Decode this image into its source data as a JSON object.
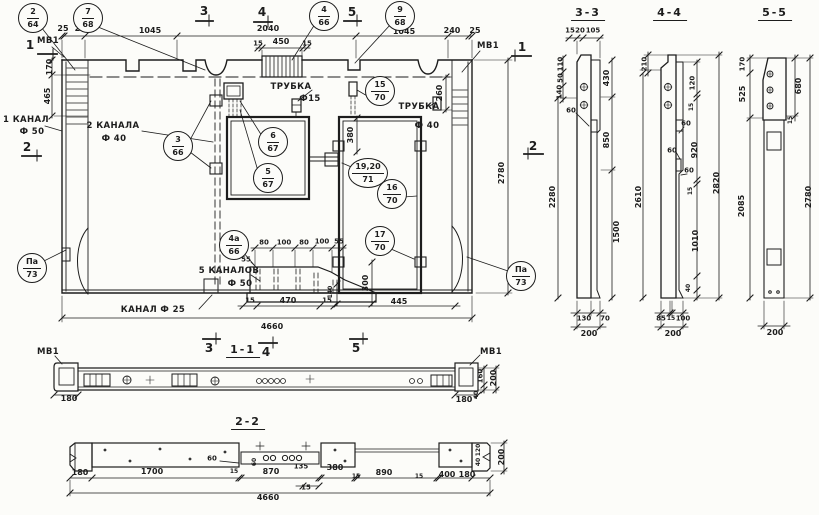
{
  "colors": {
    "ink": "#1d1d1d",
    "paper": "#fcfcf9"
  },
  "views": {
    "elevation": {
      "name": "panel-elevation",
      "texts": [
        {
          "t": "МВ1",
          "x": 48,
          "y": 41,
          "cls": "label",
          "n": "mv1-label"
        },
        {
          "t": "МВ1",
          "x": 488,
          "y": 46,
          "cls": "label",
          "n": "mv1-label"
        },
        {
          "t": "1 КАНАЛ",
          "x": 26,
          "y": 120,
          "cls": "label",
          "n": "canal1-label"
        },
        {
          "t": "Ф 50",
          "x": 32,
          "y": 132,
          "cls": "label",
          "n": "canal1-dia"
        },
        {
          "t": "2 КАНАЛА",
          "x": 113,
          "y": 126,
          "cls": "label",
          "n": "canal2-label"
        },
        {
          "t": "Ф 40",
          "x": 114,
          "y": 139,
          "cls": "label",
          "n": "canal2-dia"
        },
        {
          "t": "ТРУБКА",
          "x": 291,
          "y": 87,
          "cls": "label",
          "n": "tube-label"
        },
        {
          "t": "Ф15",
          "x": 310,
          "y": 99,
          "cls": "label",
          "n": "tube-dia"
        },
        {
          "t": "ТРУБКА",
          "x": 419,
          "y": 107,
          "cls": "label",
          "n": "tube-label"
        },
        {
          "t": "Ф 40",
          "x": 427,
          "y": 126,
          "cls": "label",
          "n": "tube-dia"
        },
        {
          "t": "5 КАНАЛОВ",
          "x": 229,
          "y": 271,
          "cls": "label",
          "n": "canals5-label"
        },
        {
          "t": "Ф 50",
          "x": 240,
          "y": 284,
          "cls": "label",
          "n": "canals5-dia"
        },
        {
          "t": "КАНАЛ Ф 25",
          "x": 153,
          "y": 310,
          "cls": "label",
          "n": "canal25-label"
        },
        {
          "t": "1",
          "x": 30,
          "y": 45,
          "cls": "mark"
        },
        {
          "t": "1",
          "x": 522,
          "y": 47,
          "cls": "mark"
        },
        {
          "t": "2",
          "x": 27,
          "y": 147,
          "cls": "mark"
        },
        {
          "t": "2",
          "x": 533,
          "y": 146,
          "cls": "mark"
        },
        {
          "t": "3",
          "x": 204,
          "y": 11,
          "cls": "mark"
        },
        {
          "t": "4",
          "x": 262,
          "y": 12,
          "cls": "mark"
        },
        {
          "t": "5",
          "x": 352,
          "y": 12,
          "cls": "mark"
        },
        {
          "t": "3",
          "x": 209,
          "y": 348,
          "cls": "mark"
        },
        {
          "t": "4",
          "x": 266,
          "y": 352,
          "cls": "mark"
        },
        {
          "t": "5",
          "x": 356,
          "y": 348,
          "cls": "mark"
        },
        {
          "t": "25",
          "x": 63,
          "y": 29
        },
        {
          "t": "240",
          "x": 83,
          "y": 29
        },
        {
          "t": "1045",
          "x": 150,
          "y": 31
        },
        {
          "t": "2040",
          "x": 268,
          "y": 29
        },
        {
          "t": "1045",
          "x": 404,
          "y": 32
        },
        {
          "t": "240",
          "x": 452,
          "y": 31
        },
        {
          "t": "25",
          "x": 475,
          "y": 31
        },
        {
          "t": "15",
          "x": 258,
          "y": 44,
          "s": 7
        },
        {
          "t": "450",
          "x": 281,
          "y": 42
        },
        {
          "t": "15",
          "x": 307,
          "y": 44,
          "s": 7
        },
        {
          "t": "170",
          "x": 50,
          "y": 67,
          "r": -90
        },
        {
          "t": "465",
          "x": 48,
          "y": 96,
          "r": -90
        },
        {
          "t": "260",
          "x": 440,
          "y": 93,
          "r": -90
        },
        {
          "t": "2780",
          "x": 502,
          "y": 173,
          "r": -90
        },
        {
          "t": "380",
          "x": 351,
          "y": 135,
          "r": -90
        },
        {
          "t": "300",
          "x": 366,
          "y": 283,
          "r": -90
        },
        {
          "t": "140",
          "x": 331,
          "y": 292,
          "r": -90,
          "s": 6
        },
        {
          "t": "80",
          "x": 264,
          "y": 243,
          "s": 7
        },
        {
          "t": "100",
          "x": 284,
          "y": 243,
          "s": 7
        },
        {
          "t": "80",
          "x": 304,
          "y": 243,
          "s": 7
        },
        {
          "t": "100",
          "x": 322,
          "y": 242,
          "s": 7
        },
        {
          "t": "55",
          "x": 339,
          "y": 242,
          "s": 7
        },
        {
          "t": "55",
          "x": 246,
          "y": 260,
          "s": 7
        },
        {
          "t": "15",
          "x": 250,
          "y": 301,
          "s": 7
        },
        {
          "t": "470",
          "x": 288,
          "y": 301
        },
        {
          "t": "15",
          "x": 327,
          "y": 301,
          "s": 7
        },
        {
          "t": "445",
          "x": 399,
          "y": 302
        },
        {
          "t": "4660",
          "x": 272,
          "y": 327
        }
      ],
      "callouts": [
        {
          "pos": "2",
          "sheet": "64",
          "x": 33,
          "y": 18
        },
        {
          "pos": "7",
          "sheet": "68",
          "x": 88,
          "y": 18
        },
        {
          "pos": "4",
          "sheet": "66",
          "x": 324,
          "y": 16
        },
        {
          "pos": "9",
          "sheet": "68",
          "x": 400,
          "y": 16
        },
        {
          "pos": "3",
          "sheet": "66",
          "x": 178,
          "y": 146
        },
        {
          "pos": "6",
          "sheet": "67",
          "x": 273,
          "y": 142
        },
        {
          "pos": "5",
          "sheet": "67",
          "x": 268,
          "y": 178
        },
        {
          "pos": "15",
          "sheet": "70",
          "x": 380,
          "y": 91
        },
        {
          "pos": "19,20",
          "sheet": "71",
          "x": 368,
          "y": 173
        },
        {
          "pos": "16",
          "sheet": "70",
          "x": 392,
          "y": 194
        },
        {
          "pos": "17",
          "sheet": "70",
          "x": 380,
          "y": 241
        },
        {
          "pos": "4а",
          "sheet": "66",
          "x": 234,
          "y": 245
        },
        {
          "pos": "Па",
          "sheet": "73",
          "x": 32,
          "y": 268
        },
        {
          "pos": "Па",
          "sheet": "73",
          "x": 521,
          "y": 276
        }
      ]
    },
    "section_3_3": {
      "name": "section-3-3",
      "texts": [
        {
          "t": "3-3",
          "x": 588,
          "y": 14,
          "cls": "title",
          "n": "section-title"
        },
        {
          "t": "15",
          "x": 570,
          "y": 31,
          "s": 7
        },
        {
          "t": "20",
          "x": 580,
          "y": 31,
          "s": 7
        },
        {
          "t": "105",
          "x": 593,
          "y": 31,
          "s": 7
        },
        {
          "t": "110",
          "x": 561,
          "y": 64,
          "r": -90,
          "s": 7
        },
        {
          "t": "50",
          "x": 561,
          "y": 78,
          "r": -90,
          "s": 7
        },
        {
          "t": "140",
          "x": 560,
          "y": 92,
          "r": -90,
          "s": 7
        },
        {
          "t": "60",
          "x": 571,
          "y": 111,
          "s": 7
        },
        {
          "t": "2280",
          "x": 553,
          "y": 197,
          "r": -90
        },
        {
          "t": "430",
          "x": 607,
          "y": 78,
          "r": -90
        },
        {
          "t": "850",
          "x": 607,
          "y": 140,
          "r": -90
        },
        {
          "t": "1500",
          "x": 617,
          "y": 232,
          "r": -90
        },
        {
          "t": "130",
          "x": 584,
          "y": 319,
          "s": 7
        },
        {
          "t": "70",
          "x": 605,
          "y": 319,
          "s": 7
        },
        {
          "t": "200",
          "x": 589,
          "y": 334
        }
      ]
    },
    "section_4_4": {
      "name": "section-4-4",
      "texts": [
        {
          "t": "4-4",
          "x": 670,
          "y": 14,
          "cls": "title",
          "n": "section-title"
        },
        {
          "t": "210",
          "x": 645,
          "y": 64,
          "r": -90,
          "s": 7
        },
        {
          "t": "2610",
          "x": 639,
          "y": 197,
          "r": -90
        },
        {
          "t": "120",
          "x": 693,
          "y": 83,
          "r": -90,
          "s": 7
        },
        {
          "t": "15",
          "x": 692,
          "y": 107,
          "r": -90,
          "s": 6
        },
        {
          "t": "920",
          "x": 695,
          "y": 150,
          "r": -90
        },
        {
          "t": "15",
          "x": 691,
          "y": 191,
          "r": -90,
          "s": 6
        },
        {
          "t": "1010",
          "x": 696,
          "y": 241,
          "r": -90
        },
        {
          "t": "40",
          "x": 689,
          "y": 288,
          "r": -90,
          "s": 6
        },
        {
          "t": "60",
          "x": 686,
          "y": 124,
          "s": 7
        },
        {
          "t": "60",
          "x": 672,
          "y": 151,
          "s": 7
        },
        {
          "t": "60",
          "x": 689,
          "y": 171,
          "s": 7
        },
        {
          "t": "2820",
          "x": 717,
          "y": 183,
          "r": -90
        },
        {
          "t": "85",
          "x": 661,
          "y": 319,
          "s": 7
        },
        {
          "t": "15",
          "x": 671,
          "y": 319,
          "s": 6
        },
        {
          "t": "100",
          "x": 683,
          "y": 319,
          "s": 7
        },
        {
          "t": "200",
          "x": 673,
          "y": 334
        }
      ]
    },
    "section_5_5": {
      "name": "section-5-5",
      "texts": [
        {
          "t": "5-5",
          "x": 775,
          "y": 14,
          "cls": "title",
          "n": "section-title"
        },
        {
          "t": "170",
          "x": 743,
          "y": 64,
          "r": -90,
          "s": 7
        },
        {
          "t": "525",
          "x": 743,
          "y": 94,
          "r": -90
        },
        {
          "t": "2085",
          "x": 742,
          "y": 206,
          "r": -90
        },
        {
          "t": "680",
          "x": 799,
          "y": 86,
          "r": -90
        },
        {
          "t": "15",
          "x": 791,
          "y": 120,
          "r": -90,
          "s": 6
        },
        {
          "t": "2780",
          "x": 809,
          "y": 197,
          "r": -90
        },
        {
          "t": "200",
          "x": 775,
          "y": 333
        }
      ]
    },
    "plan_1_1": {
      "name": "plan-section-1-1",
      "texts": [
        {
          "t": "1-1",
          "x": 243,
          "y": 351,
          "cls": "title",
          "n": "section-title"
        },
        {
          "t": "МВ1",
          "x": 48,
          "y": 352,
          "cls": "label",
          "n": "mv1-label"
        },
        {
          "t": "МВ1",
          "x": 491,
          "y": 352,
          "cls": "label",
          "n": "mv1-label"
        },
        {
          "t": "180",
          "x": 69,
          "y": 399
        },
        {
          "t": "180",
          "x": 464,
          "y": 400
        },
        {
          "t": "160",
          "x": 481,
          "y": 376,
          "r": -90,
          "s": 7
        },
        {
          "t": "40",
          "x": 477,
          "y": 395,
          "r": -90,
          "s": 6
        },
        {
          "t": "200",
          "x": 494,
          "y": 378,
          "r": -90
        }
      ]
    },
    "section_2_2": {
      "name": "section-2-2",
      "texts": [
        {
          "t": "2-2",
          "x": 248,
          "y": 423,
          "cls": "title",
          "n": "section-title"
        },
        {
          "t": "180",
          "x": 80,
          "y": 473
        },
        {
          "t": "1700",
          "x": 152,
          "y": 472
        },
        {
          "t": "60",
          "x": 212,
          "y": 459,
          "s": 7
        },
        {
          "t": "15",
          "x": 234,
          "y": 472,
          "s": 6
        },
        {
          "t": "60",
          "x": 255,
          "y": 462,
          "r": -90,
          "s": 6
        },
        {
          "t": "870",
          "x": 271,
          "y": 472
        },
        {
          "t": "135",
          "x": 301,
          "y": 467,
          "s": 7
        },
        {
          "t": "15",
          "x": 306,
          "y": 488,
          "s": 7
        },
        {
          "t": "380",
          "x": 335,
          "y": 468
        },
        {
          "t": "15",
          "x": 356,
          "y": 477,
          "s": 6
        },
        {
          "t": "890",
          "x": 384,
          "y": 473
        },
        {
          "t": "15",
          "x": 419,
          "y": 477,
          "s": 6
        },
        {
          "t": "400",
          "x": 447,
          "y": 475
        },
        {
          "t": "180",
          "x": 467,
          "y": 475
        },
        {
          "t": "4660",
          "x": 268,
          "y": 498
        },
        {
          "t": "120",
          "x": 479,
          "y": 450,
          "r": -90,
          "s": 6
        },
        {
          "t": "40",
          "x": 479,
          "y": 462,
          "r": -90,
          "s": 6
        },
        {
          "t": "200",
          "x": 502,
          "y": 457,
          "r": -90
        }
      ]
    }
  }
}
